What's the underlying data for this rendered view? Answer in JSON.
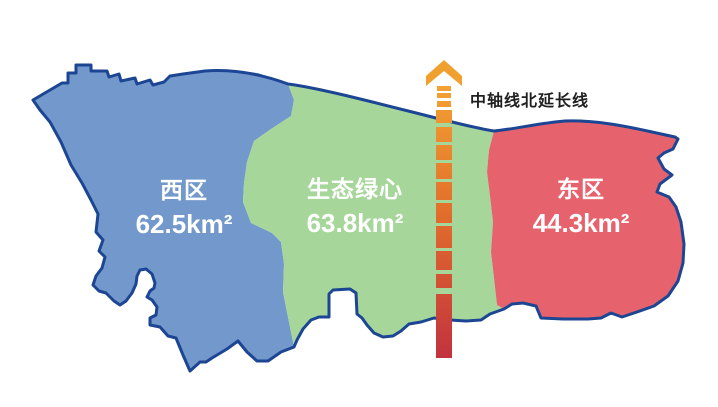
{
  "map": {
    "background": "#ffffff",
    "outline_color": "#1c4693",
    "regions": {
      "west": {
        "name": "西区",
        "area": "62.5km²",
        "fill": "#7298cc",
        "text_color": "#ffffff"
      },
      "green_heart": {
        "name": "生态绿心",
        "area": "63.8km²",
        "fill": "#a6d69a",
        "text_color": "#ffffff"
      },
      "east": {
        "name": "东区",
        "area": "44.3km²",
        "fill": "#e6636e",
        "text_color": "#ffffff"
      }
    },
    "axis_line": {
      "label": "中轴线北延长线",
      "label_color": "#1f1f1f",
      "arrow_color": "#efa02f",
      "gradient_top": "#f2a233",
      "gradient_mid": "#e2702b",
      "gradient_bottom": "#c2323e"
    }
  }
}
